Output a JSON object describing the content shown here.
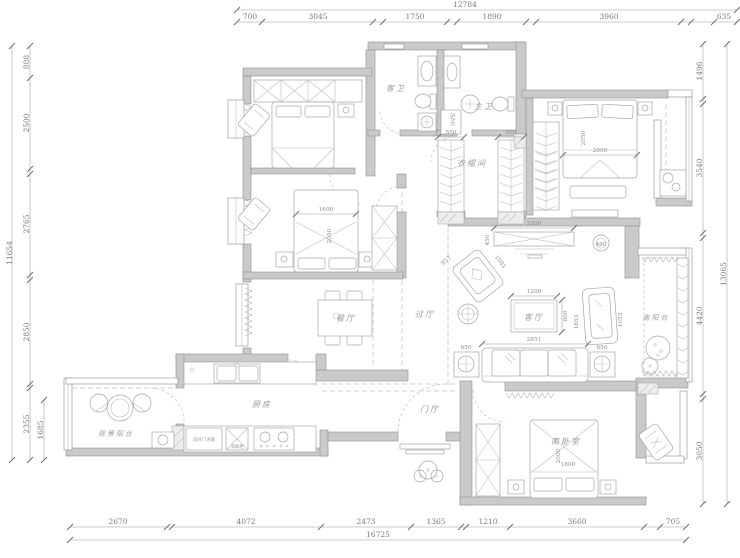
{
  "dims": {
    "top": {
      "total": "12784",
      "segments": [
        "700",
        "3045",
        "1750",
        "1890",
        "3960",
        "635"
      ]
    },
    "bottom": {
      "total": "16725",
      "segments": [
        "2670",
        "4072",
        "2473",
        "1365",
        "1210",
        "3660",
        "705"
      ]
    },
    "left": {
      "total": "11654",
      "segments": [
        "888",
        "2500",
        "2765",
        "2850",
        "2355"
      ],
      "inner": "1685"
    },
    "right": {
      "total": "13065",
      "segments": [
        "1496",
        "3540",
        "4420",
        "3050"
      ]
    }
  },
  "rooms": {
    "guest_bath": "客卫",
    "master_bath": "主卫",
    "cloakroom": "衣帽间",
    "dining": "餐厅",
    "hallway": "过厅",
    "foyer": "门厅",
    "kitchen": "厨房",
    "view_balcony": "观景阳台",
    "living": "客厅",
    "south_balcony": "南阳台",
    "south_bedroom": "南卧室"
  },
  "furniture": {
    "master_bed": {
      "width": "2000",
      "length": "2050"
    },
    "bedroom2_bed": {
      "width": "1600",
      "length": "2050"
    },
    "south_bed": {
      "width": "1800",
      "length": "2000"
    },
    "tv_cabinet": {
      "width": "2200",
      "depth": "450"
    },
    "coffee_table": {
      "width": "1200",
      "depth": "800"
    },
    "sofa": {
      "width": "2851",
      "side": "1653"
    },
    "armchair_left": {
      "width": "957",
      "depth": "1081"
    },
    "armchair_right": {
      "width": "953",
      "depth": "1053"
    },
    "end_table_left": "650",
    "end_table_right": "650",
    "stool": "480",
    "closet_rod_left": "550",
    "closet_rod_right": "550",
    "fridge": "双开门冰箱",
    "sterilizer": "消毒柜",
    "washer": "洗衣机"
  }
}
